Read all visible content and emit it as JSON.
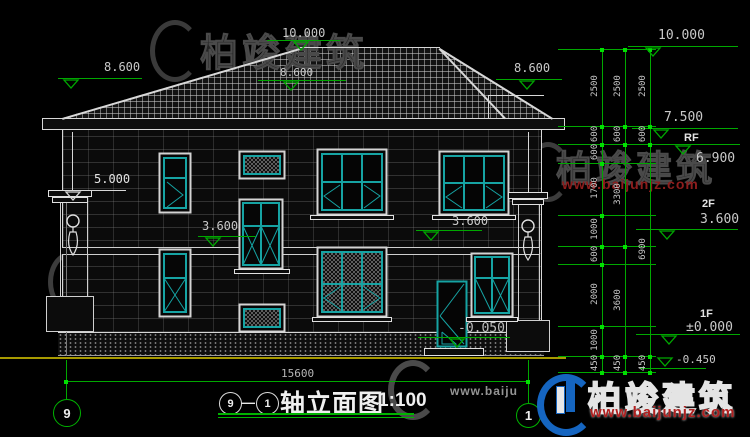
{
  "marks": {
    "apex": "10.000",
    "ridge": "8.600",
    "eave_left": "8.600",
    "eave_right": "8.600",
    "left_upper": "5.000",
    "left_mid": "3.600",
    "right_mid": "3.600",
    "entry": "-0.050"
  },
  "right_dims": {
    "colA": [
      "2500",
      "600",
      "600",
      "1700",
      "1000",
      "600",
      "2000",
      "1000",
      "450"
    ],
    "colB": [
      "2500",
      "600",
      "3300",
      "3600",
      "450"
    ],
    "colC": [
      "2500",
      "600",
      "6900",
      "450"
    ]
  },
  "levels": {
    "e10": "10.000",
    "e75": "7.500",
    "rf": "RF",
    "e69": "6.900",
    "f2": "2F",
    "e36": "3.600",
    "f1": "1F",
    "e00": "±0.000",
    "e045": "-0.450"
  },
  "bottom": {
    "overall": "15600",
    "axis_left": "9",
    "axis_right": "1"
  },
  "title": {
    "a1": "9",
    "dash": "—",
    "a2": "1",
    "name": "轴立面图",
    "scale": "1:100"
  },
  "watermark": {
    "brand": "柏竣建筑",
    "url": "www.baijunjz.com",
    "url_short": "www.baiju"
  },
  "colors": {
    "dim_green": "#00a800",
    "window_teal": "#16a3a3",
    "ground_yellow": "#a79a00",
    "url_red": "#b02020",
    "logo_blue": "#1565c0"
  }
}
